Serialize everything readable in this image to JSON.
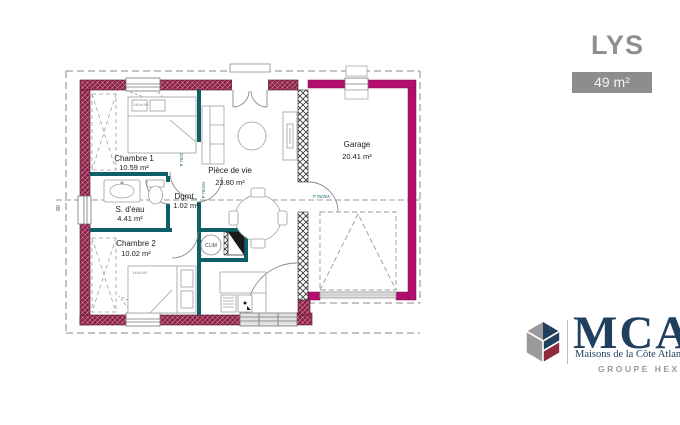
{
  "title": "LYS",
  "area_badge": "49 m²",
  "colors": {
    "wall_house": "#8d1c44",
    "wall_garage": "#b30e6e",
    "wall_interior": "#0e6068",
    "badge_bg": "#8d8d8d",
    "title_gray": "#8f8f8f",
    "logo_navy": "#21405f",
    "logo_red": "#8c2b3d",
    "logo_gray": "#9a9a9a"
  },
  "plan": {
    "rooms": [
      {
        "name": "Chambre 1",
        "area": "10.59 m²"
      },
      {
        "name": "S. d'eau",
        "area": "4.41 m²"
      },
      {
        "name": "Dgmt",
        "area": "1.02 m²"
      },
      {
        "name": "Chambre 2",
        "area": "10.02 m²"
      },
      {
        "name": "Pièce de vie",
        "area": "23.80 m²"
      },
      {
        "name": "Garage",
        "area": "20.41 m²"
      }
    ],
    "door_label": "P 75/204",
    "clim_label": "CLIM",
    "bed_labels": {
      "chambre1": "140x190",
      "chambre2": "140x200"
    },
    "dimension_left": "60"
  },
  "logo": {
    "brand": "MCA",
    "tagline": "Maisons de la Côte Atlantique",
    "group": "GROUPE HEXA"
  }
}
